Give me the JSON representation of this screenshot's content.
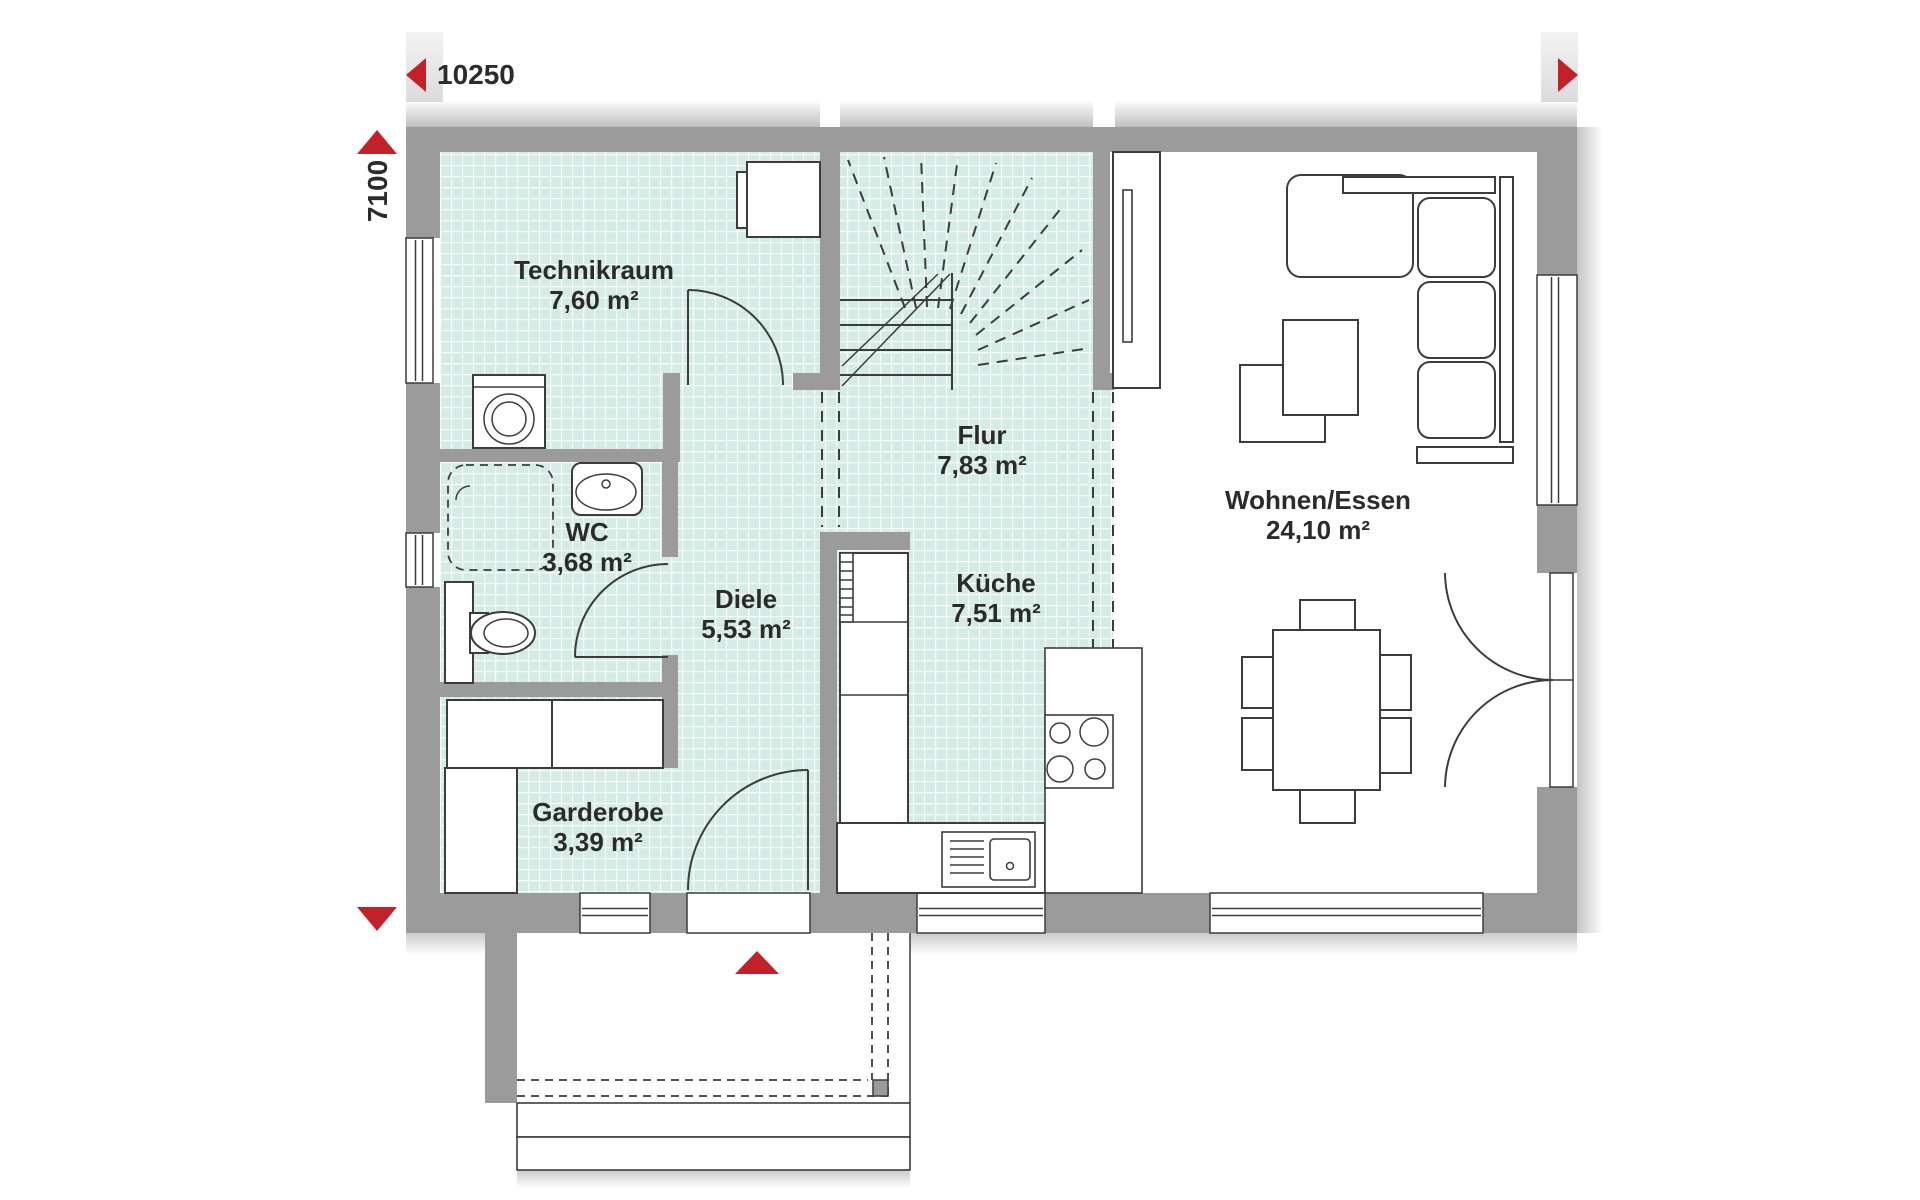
{
  "plan": {
    "dimensions": {
      "width_label": "10250",
      "height_label": "7100"
    },
    "rooms": [
      {
        "id": "technikraum",
        "name": "Technikraum",
        "area": "7,60 m²"
      },
      {
        "id": "flur",
        "name": "Flur",
        "area": "7,83 m²"
      },
      {
        "id": "wc",
        "name": "WC",
        "area": "3,68 m²"
      },
      {
        "id": "diele",
        "name": "Diele",
        "area": "5,53 m²"
      },
      {
        "id": "kueche",
        "name": "Küche",
        "area": "7,51 m²"
      },
      {
        "id": "garderobe",
        "name": "Garderobe",
        "area": "3,39 m²"
      },
      {
        "id": "wohnen_essen",
        "name": "Wohnen/Essen",
        "area": "24,10 m²"
      }
    ],
    "icons": {
      "dim_arrow_left": "left-triangle",
      "dim_arrow_right": "right-triangle",
      "dim_arrow_up": "up-triangle",
      "dim_arrow_down": "down-triangle",
      "entrance_arrow": "up-triangle"
    }
  },
  "colors": {
    "accent_red": "#c1222a",
    "wall_gray": "#9b9b9b",
    "floor_teal": "#d5ebe6",
    "line_dark": "#3c3c3c",
    "text_dark": "#2b2b2b"
  }
}
